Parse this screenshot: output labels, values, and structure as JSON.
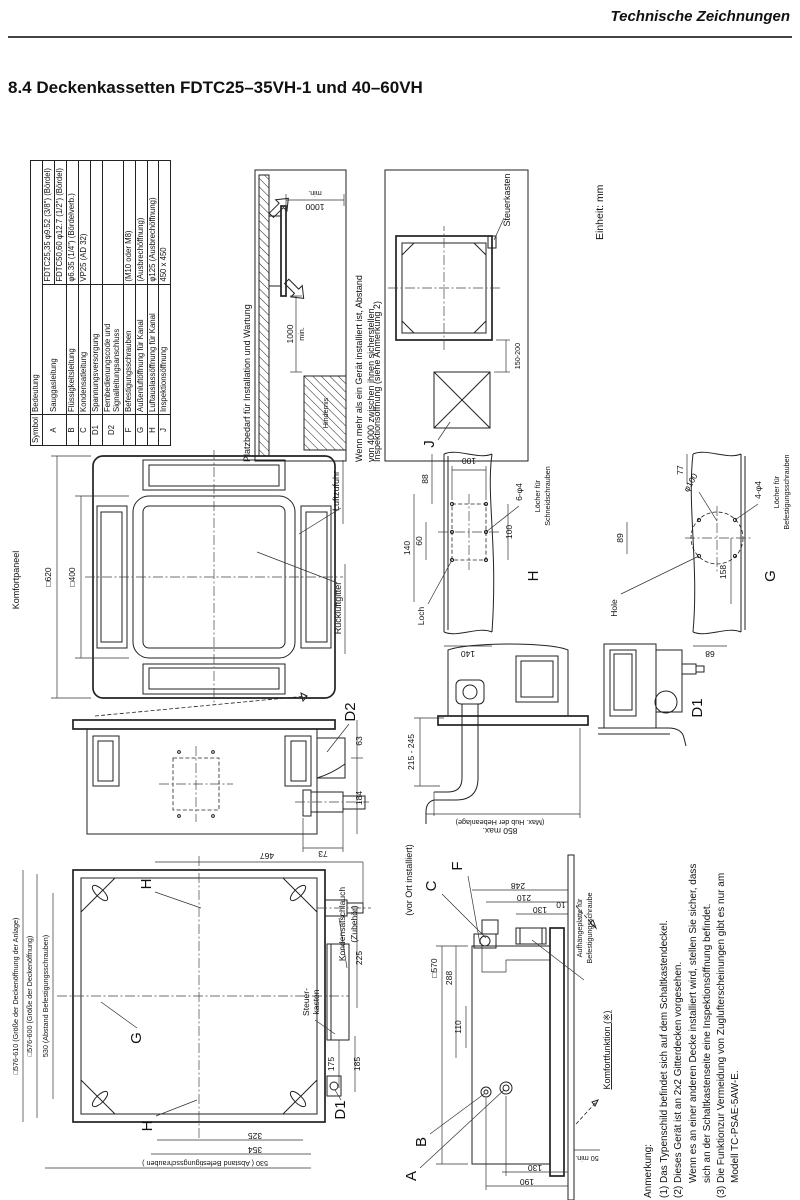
{
  "page": {
    "header": "Technische Zeichnungen",
    "title": "8.4  Deckenkassetten FDTC25–35VH-1 und 40–60VH",
    "unit": "Einheit: mm"
  },
  "symbol_table": {
    "col_symbol": "Symbol",
    "col_meaning": "Bedeutung",
    "rows": [
      {
        "sym": "A",
        "label": "Sauggasleitung",
        "value": "FDTC25,35  φ9.52 (3/8\") (Bördel)",
        "value2": "FDTC50,60  φ12.7 (1/2\") (Bördel)"
      },
      {
        "sym": "B",
        "label": "Flüssigkeitsleitung",
        "value": "φ6.35 (1/4\") (Bördelverb.)"
      },
      {
        "sym": "C",
        "label": "Kondensatleitung",
        "value": "VP25 (AD 32)"
      },
      {
        "sym": "D1",
        "label": "Spannungsversorgung",
        "value": ""
      },
      {
        "sym": "D2",
        "label": "Fernbedienungscode und Signalleitungsanschluss",
        "value": ""
      },
      {
        "sym": "F",
        "label": "Befestigungsschrauben",
        "value": "(M10 oder M8)"
      },
      {
        "sym": "G",
        "label": "Außenluftöffnung für Kanal",
        "value": "(Ausbrechöffnung)"
      },
      {
        "sym": "H",
        "label": "Luftauslassöffnung für Kanal",
        "value": "φ125 (Ausbrechöffnung)"
      },
      {
        "sym": "J",
        "label": "Inspektionsöffnung",
        "value": "450 x 450"
      }
    ]
  },
  "platzbedarf": {
    "title": "Platzbedarf für Installation und Wartung",
    "dim_a": "1000",
    "dim_a2": "min.",
    "dim_b": "1000",
    "dim_b2": "min.",
    "hindernis": "Hindernis",
    "note_line1": "Wenn mehr als ein Gerät installiert ist, Abstand",
    "note_line2": "von 4000 zwischen ihnen sicherstellen."
  },
  "inspektion": {
    "label": "Inspektionsöffnung (siehe Anmerkung 2)",
    "steuerkasten": "Steuerkasten",
    "dim": "150-200",
    "j": "J"
  },
  "panel": {
    "komfortpaneel": "Komfortpaneel",
    "dim_outer": "□620",
    "dim_inner": "□400",
    "luftzufuhr": "Luftzufuhr",
    "rueckluftgitter": "Rückluftgitter"
  },
  "h_view": {
    "d100_top": "100",
    "d88": "88",
    "d140": "140",
    "d60": "60",
    "d100_right": "100",
    "d140_bottom": "140",
    "spec": "6-φ4",
    "spec_l1": "Löcher für",
    "spec_l2": "Schneidschrauben",
    "letter": "H",
    "loch": "Loch"
  },
  "g_view": {
    "phi": "φ100",
    "d77": "77",
    "spec": "4-φ4",
    "spec_l1": "Löcher für",
    "spec_l2": "Befestigungsschrauben",
    "letter": "G",
    "d89": "89",
    "hole": "Hole",
    "d158": "158",
    "d68": "68"
  },
  "d2_view": {
    "letter": "D2",
    "d63": "63",
    "d184": "184",
    "d73": "73"
  },
  "drain_view": {
    "lift": "215 - 245",
    "max": "850  max.",
    "max_note": "(Max. Hub der Hebeanlage)"
  },
  "d1_view": {
    "letter": "D1"
  },
  "top_view": {
    "open_anlage": "□576-610 (Größe der Deckenöffnung der Anlage)",
    "open": "□576-600 (Größe der Deckenöffnung)",
    "bolts_left": "530  (Abstand Befestigungsschrauben)",
    "d467": "467",
    "d225": "225",
    "d175": "175",
    "d185": "185",
    "d325": "325",
    "d354": "354",
    "bolts_bottom": "530 ( Abstand Befestigungsschrauben )",
    "letter_h_top": "H",
    "letter_g": "G",
    "letter_h_bottom": "H",
    "letter_d1": "D1",
    "steuer_l1": "Steuer-",
    "steuer_l2": "kasten",
    "kondensat_l1": "Kondensatschlauch",
    "kondensat_l2": "(Zubehör)"
  },
  "side_view": {
    "vor_ort": "(vor Ort installiert)",
    "c": "C",
    "f": "F",
    "d570": "□570",
    "d288": "288",
    "d110": "110",
    "d248": "248",
    "d210": "210",
    "d130": "130",
    "d10": "10",
    "aufh_l1": "Aufhängeplatte für",
    "aufh_l2": "Befestigungsschraube",
    "a": "A",
    "b": "B",
    "d130b": "130",
    "d190": "190",
    "d50": "50 min.",
    "komfort": "Komfortfunktion (※)"
  },
  "anmerkung": {
    "title": "Anmerkung:",
    "line1": "(1) Das Typenschild befindet sich auf dem Schaltkastendeckel.",
    "line2": "(2) Dieses Gerät ist an 2x2 Gitterdecken vorgesehen.",
    "line3": "Wenn es an einer anderen Decke installiert wird, stellen Sie sicher, dass",
    "line4": "sich an der Schaltkastenseite eine Inspektionsöffnung befindet.",
    "line5": "(3) Die Funktionzur Vermeidung von Zuglufterscheinungen gibt es nur am",
    "line6": "Modell TC-PSAE-5AW-E."
  }
}
